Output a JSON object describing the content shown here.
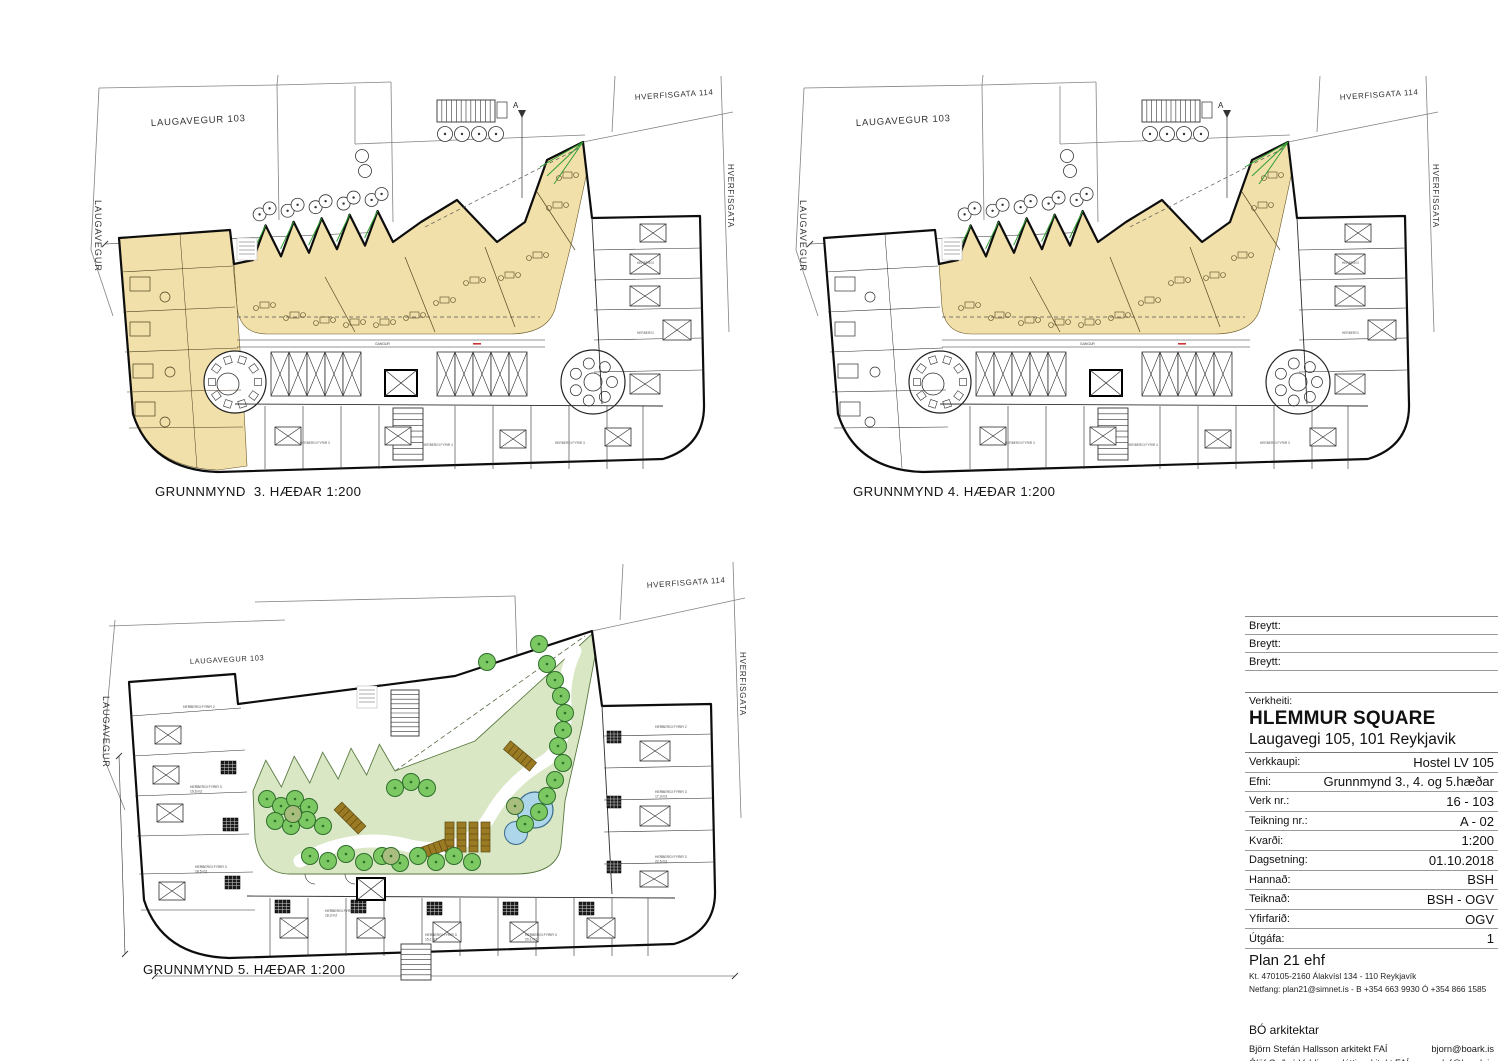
{
  "sheet": {
    "plans": [
      {
        "id": "3",
        "title": "GRUNNMYND  3. HÆÐAR 1:200",
        "highlight": "common areas and left wing highlighted"
      },
      {
        "id": "4",
        "title": "GRUNNMYND 4. HÆÐAR 1:200",
        "highlight": "common areas highlighted"
      },
      {
        "id": "5",
        "title": "GRUNNMYND 5. HÆÐAR 1:200",
        "highlight": "roof garden floor"
      }
    ],
    "street_labels": {
      "top_left": "LAUGAVEGUR 103",
      "left": "LAUGAVEGUR",
      "top_right": "HVERFISGATA 114",
      "right": "HVERFISGATA"
    },
    "section_marker": "A",
    "corridor_label": "GANGUR",
    "room_labels": {
      "upper": [
        "HERBERGI",
        "HERBERGI FYRIR 3",
        "HERBERGI FYRIR 4",
        "KLEFAR"
      ],
      "plan5": [
        "HERBERGI FYRIR 2",
        "HERBERGI FYRIR 3|19,6 m2",
        "HERBERGI FYRIR 3|18,5 m2",
        "HERBERGI FYRIR 3|18,3 m2",
        "HERBERGI FYRIR 3|15,1 m2",
        "HERBERGI FYRIR 3|20,1 m2",
        "HERBERGI FYRIR 2",
        "HERBERGI FYRIR 3|17,3 m2",
        "HERBERGI FYRIR 3|22,5 m2"
      ]
    },
    "colors": {
      "highlight_beige": "#f2e0aa",
      "garden_green": "#d9e7c4",
      "tree_green": "#7cc862",
      "tree_dark": "#a9bd7e",
      "pool_blue": "#aed6ea",
      "planter_brown": "#9a7a22",
      "accent_green": "#2f9e33",
      "wall_black": "#0d0d0d"
    }
  },
  "titleblock": {
    "revision_rows": [
      {
        "label": "Breytt:"
      },
      {
        "label": "Breytt:"
      },
      {
        "label": "Breytt:"
      }
    ],
    "project_label": "Verkheiti:",
    "project_name": "HLEMMUR SQUARE",
    "project_address": "Laugavegi 105, 101 Reykjavik",
    "rows": [
      {
        "label": "Verkkaupi:",
        "value": "Hostel LV 105"
      },
      {
        "label": "Efni:",
        "value": "Grunnmynd 3., 4. og 5.hæðar"
      },
      {
        "label": "Verk nr.:",
        "value": "16 - 103"
      },
      {
        "label": "Teikning nr.:",
        "value": "A - 02"
      },
      {
        "label": "Kvarði:",
        "value": "1:200"
      },
      {
        "label": "Dagsetning:",
        "value": "01.10.2018"
      },
      {
        "label": "Hannað:",
        "value": "BSH"
      },
      {
        "label": "Teiknað:",
        "value": "BSH - OGV"
      },
      {
        "label": "Yfirfarið:",
        "value": "OGV"
      },
      {
        "label": "Útgáfa:",
        "value": "1"
      }
    ],
    "firm": {
      "name": "Plan 21 ehf",
      "kt": "Kt. 470105-2160 Álakvísl 134 - 110 Reykjavík",
      "contact": "Netfang: plan21@simnet.is - B +354 663 9930 Ó +354 866 1585"
    },
    "architects": {
      "name": "BÓ arkitektar",
      "people": [
        {
          "name": "Björn Stefán Hallsson arkitekt FAÍ",
          "email": "bjorn@boark.is"
        },
        {
          "name": "Ólöf Guðný Valdimarsdóttir arkitekt FAÍ",
          "email": "olof@boark.is"
        }
      ]
    }
  }
}
